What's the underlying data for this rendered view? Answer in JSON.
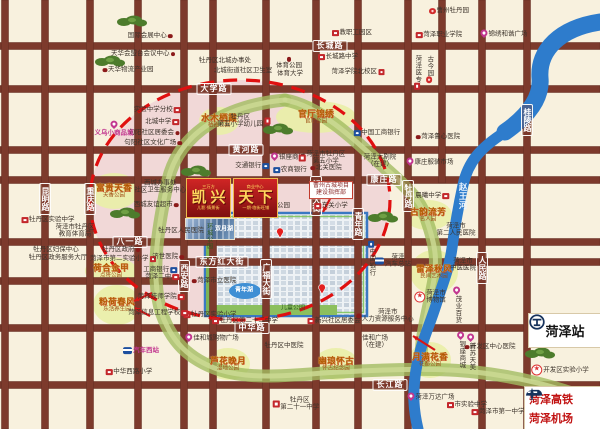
{
  "banner": {
    "tag_left": "三万方",
    "tag_right": "商业中心",
    "title_left": "凯兴",
    "title_right": "天下",
    "sub_left": "儿影·情景街",
    "sub_right": "一期·临街旺铺"
  },
  "station": {
    "name": "菏泽站"
  },
  "transport": {
    "rail": "菏泽高铁",
    "airport": "菏泽机场"
  },
  "colors": {
    "background": "#f8f1de",
    "road": "#7d3a2c",
    "river": "#2e7ccc",
    "greenbelt": "#a3bd62",
    "dashed_ring": "#e01010",
    "park_circle": "#e9efa8",
    "banner_red": "#b31717",
    "banner_gold": "#ffd75e",
    "magenta": "#c2368f",
    "rail_navy": "#16325c"
  },
  "map": {
    "road_labels": [
      {
        "id": "changcheng",
        "text": "长城路",
        "x": 330,
        "y": 46
      },
      {
        "id": "daxue",
        "text": "大学路",
        "x": 214,
        "y": 89
      },
      {
        "id": "huanghe",
        "text": "黄河路",
        "x": 246,
        "y": 150
      },
      {
        "id": "kangzhuang",
        "text": "康庄路",
        "x": 384,
        "y": 180
      },
      {
        "id": "bayi",
        "text": "八一路",
        "x": 130,
        "y": 242
      },
      {
        "id": "dongfanghong",
        "text": "东方红大街",
        "x": 222,
        "y": 262
      },
      {
        "id": "zhonghua",
        "text": "中华路",
        "x": 252,
        "y": 328
      },
      {
        "id": "changjiang",
        "text": "长江路",
        "x": 390,
        "y": 385
      },
      {
        "id": "kunming",
        "text": "昆明路",
        "x": 45,
        "y": 199,
        "v": true
      },
      {
        "id": "chongqing",
        "text": "重庆路",
        "x": 90,
        "y": 199,
        "v": true
      },
      {
        "id": "xian",
        "text": "西安路",
        "x": 184,
        "y": 276,
        "v": true
      },
      {
        "id": "guangfu",
        "text": "广福大街",
        "x": 266,
        "y": 279,
        "v": true
      },
      {
        "id": "jiefang",
        "text": "解放大街",
        "x": 316,
        "y": 196,
        "v": true
      },
      {
        "id": "qingnian",
        "text": "青年路",
        "x": 358,
        "y": 224,
        "v": true
      },
      {
        "id": "mudanlu",
        "text": "牡丹路",
        "x": 408,
        "y": 196,
        "v": true
      },
      {
        "id": "renmin",
        "text": "人民路",
        "x": 482,
        "y": 268,
        "v": true
      },
      {
        "id": "guiling",
        "text": "桂陵路",
        "x": 527,
        "y": 120,
        "v": true
      }
    ],
    "gold_sites": [
      {
        "id": "shuimu",
        "name": "水木栖霞",
        "sub": "栖霞公园",
        "x": 219,
        "y": 121,
        "rx": 20,
        "ry": 14
      },
      {
        "id": "guanting",
        "name": "官厅锦绣",
        "sub": "官厅公园",
        "x": 316,
        "y": 117,
        "rx": 40,
        "ry": 16
      },
      {
        "id": "fugui",
        "name": "富贵天香",
        "sub": "天香公园",
        "x": 114,
        "y": 191,
        "rx": 25,
        "ry": 18
      },
      {
        "id": "hehe",
        "name": "荷合金甲",
        "sub": "点将公园",
        "x": 111,
        "y": 271,
        "rx": 26,
        "ry": 14
      },
      {
        "id": "fenhe",
        "name": "粉荷春风",
        "sub": "乐活养生园",
        "x": 117,
        "y": 305,
        "rx": 24,
        "ry": 20
      },
      {
        "id": "luhua",
        "name": "芦花晚月",
        "sub": "湿地公园",
        "x": 228,
        "y": 364,
        "rx": 22,
        "ry": 16
      },
      {
        "id": "youlan",
        "name": "幽琅怀古",
        "sub": "怀古纪念园",
        "x": 336,
        "y": 364,
        "rx": 22,
        "ry": 16
      },
      {
        "id": "yueman",
        "name": "月满花香",
        "sub": "花都公园",
        "x": 430,
        "y": 360,
        "rx": 21,
        "ry": 18
      },
      {
        "id": "guyun",
        "name": "古韵流芳",
        "sub": "名人园",
        "x": 428,
        "y": 215,
        "rx": 24,
        "ry": 15
      },
      {
        "id": "leize",
        "name": "雷泽秋风",
        "sub": "民间艺术园",
        "x": 434,
        "y": 272,
        "rx": 24,
        "ry": 22
      }
    ],
    "labels": [
      {
        "id": "intl-expo",
        "text": "国际会展中心",
        "x": 150,
        "y": 36,
        "icon": "dot",
        "side": "r"
      },
      {
        "id": "tianhua-conference",
        "text": "天华会盟台会议中心",
        "x": 143,
        "y": 54,
        "icon": "dot",
        "side": "r"
      },
      {
        "id": "tianhua-logistics",
        "text": "天华物流产业园",
        "x": 128,
        "y": 70,
        "icon": "dot",
        "side": "l"
      },
      {
        "id": "shiyan-branch",
        "text": "实验中学分校",
        "x": 157,
        "y": 110,
        "icon": "sq",
        "side": "r"
      },
      {
        "id": "beicheng-middle",
        "text": "北城中学",
        "x": 162,
        "y": 122,
        "icon": "sq",
        "side": "r"
      },
      {
        "id": "juyang-committee",
        "text": "句阳社区居委会",
        "x": 154,
        "y": 133,
        "icon": "dot",
        "side": "r"
      },
      {
        "id": "juyang-plaza",
        "text": "句阳社区文化广场",
        "x": 153,
        "y": 143,
        "icon": "dot",
        "side": "r"
      },
      {
        "id": "yiwu-market",
        "text": "义乌小商品城",
        "x": 114,
        "y": 129,
        "icon": "pin",
        "side": "t",
        "cls": "magenta"
      },
      {
        "id": "beicheng-office",
        "text": "牡丹区北城办事处",
        "x": 225,
        "y": 61
      },
      {
        "id": "beicheng-clinic",
        "text": "北城街道社区卫生室",
        "x": 243,
        "y": 71
      },
      {
        "id": "sports-park",
        "text": "体育公园",
        "x": 289,
        "y": 63,
        "icon": "dot",
        "side": "t"
      },
      {
        "id": "sports-univ",
        "text": "体育大学",
        "x": 290,
        "y": 74
      },
      {
        "id": "changcheng-middle",
        "text": "长城路中学",
        "x": 338,
        "y": 57,
        "icon": "sq",
        "side": "l"
      },
      {
        "id": "heze-college-north",
        "text": "菏泽学院北校区",
        "x": 358,
        "y": 72,
        "icon": "sq",
        "side": "r"
      },
      {
        "id": "staff-park",
        "text": "教职工园区",
        "x": 352,
        "y": 33,
        "icon": "sq",
        "side": "l"
      },
      {
        "id": "caozhou-peony-garden",
        "text": "曹州牡丹园",
        "x": 449,
        "y": 11,
        "icon": "flower",
        "side": "l"
      },
      {
        "id": "heze-vocational",
        "text": "菏泽职业学院",
        "x": 439,
        "y": 35,
        "icon": "sq",
        "side": "l"
      },
      {
        "id": "hexie-plaza",
        "text": "锦绣和谐广场",
        "x": 504,
        "y": 34,
        "icon": "pin",
        "side": "l"
      },
      {
        "id": "heze-medical",
        "text": "菏泽医专",
        "x": 417,
        "y": 72,
        "icon": "sq",
        "side": "b",
        "v": true
      },
      {
        "id": "gujin-garden",
        "text": "古今园",
        "x": 429,
        "y": 69,
        "icon": "flower",
        "side": "b",
        "v": true
      },
      {
        "id": "luxin-hospital",
        "text": "菏泽鲁心医院",
        "x": 438,
        "y": 137,
        "icon": "dot",
        "side": "l"
      },
      {
        "id": "no5-kindergarten",
        "lines": [
          "牡丹区",
          "第五小学幼儿园"
        ],
        "x": 244,
        "y": 121,
        "icon": "sq",
        "side": "r"
      },
      {
        "id": "icbc-north",
        "text": "中国工商银行",
        "x": 377,
        "y": 133,
        "icon": "bank",
        "side": "l"
      },
      {
        "id": "grand-theater",
        "lines": [
          "菏泽大剧院",
          "（在建）"
        ],
        "x": 380,
        "y": 161
      },
      {
        "id": "kangzhuang-market",
        "text": "康庄服装市场",
        "x": 430,
        "y": 162,
        "icon": "pin",
        "side": "l"
      },
      {
        "id": "yinzuo-mall-north",
        "text": "银座商城",
        "x": 288,
        "y": 157,
        "icon": "pin",
        "side": "l"
      },
      {
        "id": "no5-primary",
        "lines": [
          "菏泽市牡丹区",
          "第五小学"
        ],
        "x": 322,
        "y": 158,
        "icon": "sq",
        "side": "l"
      },
      {
        "id": "bocom",
        "text": "交通银行",
        "x": 252,
        "y": 166,
        "icon": "bank",
        "side": "r"
      },
      {
        "id": "rural-bank",
        "text": "农商银行",
        "x": 290,
        "y": 170,
        "icon": "bank",
        "side": "l"
      },
      {
        "id": "beiguan-hospital",
        "text": "北关医院",
        "x": 326,
        "y": 168,
        "icon": "dot",
        "side": "l"
      },
      {
        "id": "mudan-people-hospital",
        "text": "牡丹区人民医院",
        "x": 181,
        "y": 231
      },
      {
        "id": "xiangguo-park",
        "text": "相国公园",
        "x": 277,
        "y": 206
      },
      {
        "id": "caozhou-hq",
        "lines": [
          "曹州古城项目",
          "建设指挥部"
        ],
        "x": 331,
        "y": 190,
        "cls": "box"
      },
      {
        "id": "dongguan-primary",
        "text": "东关小学",
        "x": 331,
        "y": 206,
        "icon": "sq",
        "side": "l"
      },
      {
        "id": "xicheng-health",
        "lines": [
          "西城办事处",
          "社区卫生服务中心"
        ],
        "x": 163,
        "y": 187,
        "icon": "dot",
        "side": "r"
      },
      {
        "id": "xicheng-market",
        "text": "西城友谊超市",
        "x": 156,
        "y": 205,
        "icon": "dot",
        "side": "r"
      },
      {
        "id": "mudan-exp-middle",
        "text": "牡丹区实验中学",
        "x": 48,
        "y": 220,
        "icon": "sq",
        "side": "l"
      },
      {
        "id": "edu-bureau",
        "lines": [
          "菏泽市牡丹区",
          "教育体育局"
        ],
        "x": 75,
        "y": 231
      },
      {
        "id": "fubao-center",
        "text": "牡丹区妇保中心",
        "x": 56,
        "y": 250
      },
      {
        "id": "service-hall",
        "text": "牡丹区政务服务大厅",
        "x": 58,
        "y": 258
      },
      {
        "id": "mudan-gov",
        "text": "牡丹区政府",
        "x": 121,
        "y": 250,
        "icon": "dot",
        "side": "r"
      },
      {
        "id": "no2-exp-primary",
        "text": "菏泽市第二实验小学",
        "x": 123,
        "y": 259,
        "icon": "sq",
        "side": "r"
      },
      {
        "id": "jishi-hospital",
        "text": "济世医院",
        "x": 168,
        "y": 257,
        "icon": "dot",
        "side": "r"
      },
      {
        "id": "icbc-west",
        "text": "工商银行",
        "x": 160,
        "y": 270,
        "icon": "bank",
        "side": "r"
      },
      {
        "id": "heze-no2-middle",
        "text": "菏泽二中",
        "x": 162,
        "y": 277,
        "icon": "sq",
        "side": "r"
      },
      {
        "id": "city-hospital",
        "text": "菏泽市立医院",
        "x": 214,
        "y": 281,
        "icon": "dot",
        "side": "l"
      },
      {
        "id": "boc",
        "text": "中国银行",
        "x": 371,
        "y": 258,
        "icon": "bank",
        "side": "t",
        "v": true
      },
      {
        "id": "bus-station-east",
        "lines": [
          "菏泽",
          "汽车总站"
        ],
        "x": 393,
        "y": 261,
        "icon": "bus",
        "side": "l"
      },
      {
        "id": "no2-people-hospital",
        "lines": [
          "菏泽市",
          "第二人民医院"
        ],
        "x": 456,
        "y": 230
      },
      {
        "id": "chenxi-middle",
        "text": "晨曦中学",
        "x": 432,
        "y": 196,
        "icon": "sq",
        "side": "r"
      },
      {
        "id": "tcm-hospital",
        "lines": [
          "菏泽市",
          "中医医院"
        ],
        "x": 463,
        "y": 265
      },
      {
        "id": "mudan-exp-primary",
        "text": "牡丹区实验小学",
        "x": 210,
        "y": 315,
        "icon": "sq",
        "side": "l"
      },
      {
        "id": "no22-middle",
        "text": "牡丹区第二十二中学",
        "x": 245,
        "y": 321,
        "icon": "sq",
        "side": "l"
      },
      {
        "id": "xinxing-committee",
        "text": "新兴社区居委会",
        "x": 334,
        "y": 321,
        "icon": "sq",
        "side": "l"
      },
      {
        "id": "hr-center",
        "lines": [
          "菏泽市",
          "人力资源服务中心"
        ],
        "x": 385,
        "y": 316,
        "icon": "dot",
        "side": "l"
      },
      {
        "id": "jiahe-mall",
        "text": "佳和城购物广场",
        "x": 212,
        "y": 338,
        "icon": "pin",
        "side": "l"
      },
      {
        "id": "mudan-tcm",
        "text": "牡丹区中医院",
        "x": 284,
        "y": 346
      },
      {
        "id": "jiahe-plaza",
        "lines": [
          "佳和广场",
          "（在建）"
        ],
        "x": 375,
        "y": 342
      },
      {
        "id": "dev-hospital",
        "text": "开发区中心医院",
        "x": 490,
        "y": 347,
        "icon": "dot",
        "side": "l"
      },
      {
        "id": "dev-exp-primary",
        "text": "开发区实验小学",
        "x": 560,
        "y": 370,
        "icon": "star",
        "side": "l"
      },
      {
        "id": "wanda",
        "text": "菏泽万达广场",
        "x": 431,
        "y": 397,
        "icon": "pin",
        "side": "l"
      },
      {
        "id": "city-exp-middle",
        "text": "市实验中学",
        "x": 467,
        "y": 405,
        "icon": "sq",
        "side": "l"
      },
      {
        "id": "no1-middle",
        "text": "菏泽市第一中学",
        "x": 498,
        "y": 412,
        "icon": "sq",
        "side": "l"
      },
      {
        "id": "no21-middle",
        "lines": [
          "牡丹区",
          "第二十一中学"
        ],
        "x": 296,
        "y": 404,
        "icon": "sq",
        "side": "l"
      },
      {
        "id": "bus-station-west",
        "text": "汽车西站",
        "x": 141,
        "y": 351,
        "icon": "bus",
        "side": "l",
        "cls": "magenta"
      },
      {
        "id": "zhonghuaxilu-primary",
        "text": "中华西路小学",
        "x": 129,
        "y": 372,
        "icon": "sq",
        "side": "l"
      },
      {
        "id": "jishi-college",
        "text": "菏泽技师学院",
        "x": 161,
        "y": 297,
        "icon": "sq",
        "side": "r"
      },
      {
        "id": "info-school",
        "text": "菏泽信息工程学校",
        "x": 158,
        "y": 313,
        "icon": "sq",
        "side": "r"
      },
      {
        "id": "heze-museum",
        "lines": [
          "菏泽市",
          "博物馆"
        ],
        "x": 430,
        "y": 297,
        "icon": "star",
        "side": "l"
      },
      {
        "id": "maoye",
        "text": "茂业百货",
        "x": 457,
        "y": 305,
        "icon": "pin",
        "side": "t",
        "v": true
      },
      {
        "id": "yinzuo-mall-south",
        "text": "银座商城",
        "x": 461,
        "y": 350,
        "icon": "pin",
        "side": "t",
        "v": true
      },
      {
        "id": "xinsu-tianmei",
        "text": "新苏天美",
        "x": 471,
        "y": 352,
        "icon": "pin",
        "side": "t",
        "v": true
      },
      {
        "id": "children-park",
        "text": "儿童公园",
        "x": 293,
        "y": 309,
        "cls": "green"
      },
      {
        "id": "youth-lake",
        "text": "青年湖",
        "x": 244,
        "y": 291,
        "cls": "lake"
      },
      {
        "id": "shuangyue-lake",
        "text": "双月湖",
        "x": 224,
        "y": 230,
        "cls": "lake"
      },
      {
        "id": "ring-park",
        "text": "环城公园",
        "x": 208,
        "y": 236,
        "cls": "green",
        "v": true
      },
      {
        "id": "zhaowang-river",
        "text": "赵王河",
        "x": 463,
        "y": 196,
        "cls": "riv",
        "v": true
      },
      {
        "id": "glory-center",
        "text": "荣耀中心",
        "x": 253,
        "y": 211,
        "cls": "tinyred"
      }
    ],
    "trees": [
      [
        132,
        22
      ],
      [
        110,
        62
      ],
      [
        125,
        214
      ],
      [
        278,
        130
      ],
      [
        196,
        172
      ],
      [
        383,
        218
      ],
      [
        540,
        354
      ]
    ],
    "arrows": [
      [
        152,
        293,
        134,
        301
      ],
      [
        150,
        316,
        135,
        308
      ],
      [
        435,
        350,
        413,
        336
      ],
      [
        331,
        197,
        323,
        212
      ]
    ],
    "project_pins": [
      [
        280,
        238
      ],
      [
        322,
        294
      ]
    ]
  }
}
